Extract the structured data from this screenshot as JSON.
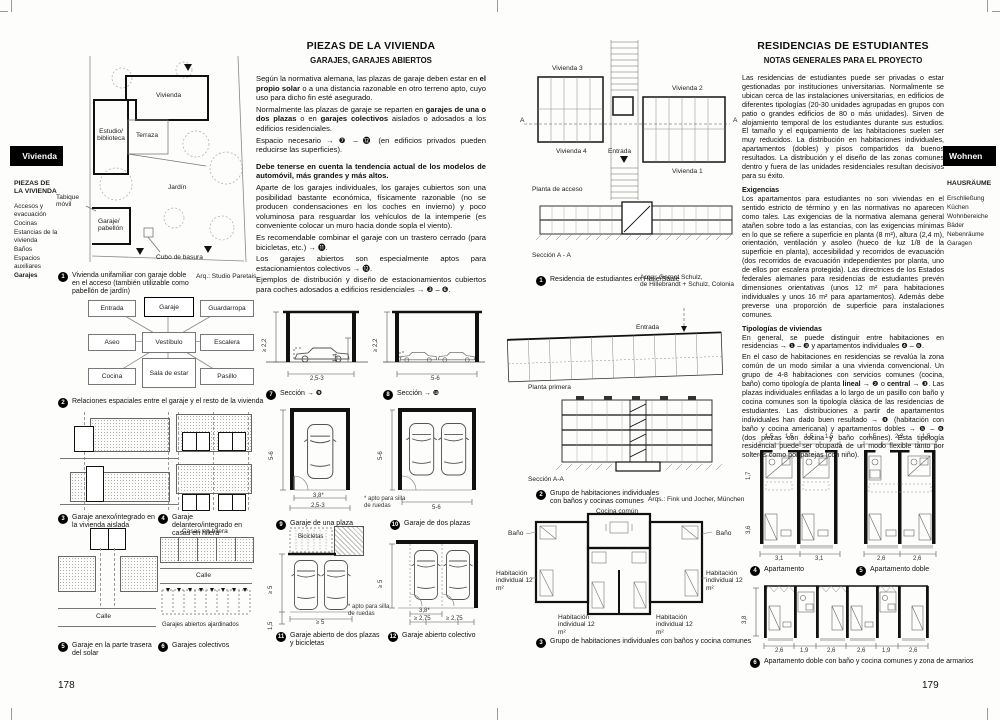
{
  "left_page": {
    "page_number": "178",
    "tab_label": "Vivienda",
    "sidebar": {
      "heading": "PIEZAS DE LA VIVIENDA",
      "items": [
        "Accesos y evacuación",
        "Cocinas",
        "Estancias de la vivienda",
        "Baños",
        "Espacios auxiliares",
        "Garajes"
      ]
    },
    "title": "PIEZAS DE LA VIVIENDA",
    "subtitle": "GARAJES, GARAJES ABIERTOS",
    "body": {
      "p1_a": "Según la normativa alemana, las plazas de garaje deben estar en ",
      "p1_b": "el propio solar",
      "p1_c": " o a una distancia razonable en otro terreno apto, cuyo uso para dicho fin esté asegurado.",
      "p2_a": "Normalmente las plazas de garaje se reparten en ",
      "p2_b": "garajes de una o dos plazas",
      "p2_c": " o en ",
      "p2_d": "garajes colectivos",
      "p2_e": " aislados o adosados a los edificios residenciales.",
      "p3": "Espacio necesario → ❼ – ⓬ (en edificios privados pueden reducirse las superficies).",
      "p4": "Debe tenerse en cuenta la tendencia actual de los modelos de automóvil, más grandes y más altos.",
      "p5": "Aparte de los garajes individuales, los garajes cubiertos son una posibilidad bastante económica, físicamente razonable (no se producen condensaciones en los coches en invierno) y poco voluminosa para resguardar los vehículos de la intemperie (es conveniente colocar un muro hacia donde sopla el viento).",
      "p6": "Es recomendable combinar el garaje con un trastero cerrado (para bicicletas, etc.) → ⓫.",
      "p7": "Los garajes abiertos son especialmente aptos para estacionamientos colectivos → ⓬.",
      "p8": "Ejemplos de distribución y diseño de estacionamientos cubiertos para coches adosados a edificios residenciales → ❸ – ❻."
    },
    "fig1": {
      "num": "1",
      "caption": "Vivienda unifamiliar con garaje doble en el acceso (también utilizable como pabellón de jardín)",
      "credit": "Arq.: Studio Paretais",
      "labels": {
        "vivienda": "Vivienda",
        "estudio": "Estudio/ biblioteca",
        "terraza": "Terraza",
        "jardin": "Jardín",
        "tabique": "Tabique móvil",
        "garaje": "Garaje/ pabellón",
        "cubo": "Cubo de basura"
      }
    },
    "fig2": {
      "num": "2",
      "caption": "Relaciones espaciales entre el garaje y el resto de la vivienda",
      "boxes": [
        "Entrada",
        "Garaje",
        "Guardarropa",
        "Aseo",
        "Vestíbulo",
        "Escalera",
        "Cocina",
        "Sala de estar",
        "Pasillo"
      ]
    },
    "fig3": {
      "num": "3",
      "caption": "Garaje anexo/integrado en la vivienda aislada"
    },
    "fig4": {
      "num": "4",
      "caption": "Garaje delantero/integrado en casas en hilera"
    },
    "fig5": {
      "num": "5",
      "caption": "Garaje en la parte trasera del solar",
      "label_calle": "Calle"
    },
    "fig6": {
      "num": "6",
      "caption": "Garajes colectivos",
      "labels": [
        "Casas en hilera",
        "Calle",
        "Garajes abiertos ajardinados"
      ]
    },
    "fig7": {
      "num": "7",
      "caption": "Sección → ❾",
      "dims": {
        "h": "≥ 2,2",
        "door": "1,4",
        "w": "2,5-3"
      }
    },
    "fig8": {
      "num": "8",
      "caption": "Sección → ❿",
      "dims": {
        "h": "≥ 2,2",
        "w": "5-6"
      }
    },
    "fig9": {
      "num": "9",
      "caption": "Garaje de una plaza",
      "dims": {
        "d": "5-6",
        "w1": "3,8*",
        "w2": "2,5-3"
      },
      "note": "* apto para silla de ruedas"
    },
    "fig10": {
      "num": "10",
      "caption": "Garaje de dos plazas",
      "dims": {
        "d": "5-6",
        "w": "5-6"
      }
    },
    "fig11": {
      "num": "11",
      "caption": "Garaje abierto de dos plazas y bicicletas",
      "label": "Bicicletas",
      "dims": {
        "d": "≥ 5",
        "strip": "1,5",
        "w": "≥ 5"
      }
    },
    "fig12": {
      "num": "12",
      "caption": "Garaje abierto colectivo",
      "note": "* apto para silla de ruedas",
      "dims": {
        "d": "≥ 5",
        "w1": "3,8*",
        "w2": "≥ 2,75",
        "w3": "≥ 2,75"
      }
    }
  },
  "right_page": {
    "page_number": "179",
    "tab_label": "Wohnen",
    "sidebar": {
      "heading": "HAUSRÄUME",
      "items": [
        "Erschließung",
        "Küchen",
        "Wohnbereiche",
        "Bäder",
        "Nebenräume",
        "Garagen"
      ]
    },
    "title": "RESIDENCIAS DE ESTUDIANTES",
    "subtitle": "NOTAS GENERALES PARA EL PROYECTO",
    "body": {
      "intro": "Las residencias de estudiantes puede ser privadas o estar gestionadas por instituciones universitarias. Normalmente se ubican cerca de las instalaciones universitarias, en edificios de diferentes tipologías (20-30 unidades agrupadas en grupos con patio o grandes edificios de 80 o más unidades). Sirven de alojamiento temporal de los estudiantes durante sus estudios. El tamaño y el equipamiento de las habitaciones suelen ser muy reducidos. La distribución en habitaciones individuales, apartamentos (dobles) y pisos compartidos da buenos resultados. La distribución y el diseño de las zonas comunes dentro y fuera de las unidades residenciales resultan decisivos para su éxito.",
      "h_exigencias": "Exigencias",
      "exigencias": "Los apartamentos para estudiantes no son viviendas en el sentido estricto de término y en las normativas no aparecen como tales. Las exigencias de la normativa alemana general atañen sobre todo a las estancias, con las exigencias mínimas en lo que se refiere a superficie en planta (8 m²), altura (2,4 m), orientación, ventilación y asoleo (hueco de luz 1/8 de la superficie en planta), accesibilidad y recorridos de evacuación (dos recorridos de evacuación independientes por planta, uno de ellos por escalera protegida). Las directrices de los Estados federales alemanes para residencias de estudiantes prevén dimensiones orientativas (unos 12 m² para habitaciones individuales y unos 16 m² para apartamentos). Además debe preverse una proporción de superficie para instalaciones comunes.",
      "h_tipologias": "Tipologías de viviendas",
      "tip_a": "En general, se puede distinguir entre habitaciones en residencias → ❶ – ❸ y apartamentos individuales ❹ – ❻.",
      "tip_b": "En el caso de habitaciones en residencias se revalúa la zona común de un modo similar a una vivienda convencional. Un grupo de 4-8 habitaciones con servicios comunes (cocina, baño) como tipología de planta ",
      "tip_bold1": "lineal",
      "tip_c": " → ❷ o ",
      "tip_bold2": "central",
      "tip_d": " → ❸. Las plazas individuales enfiladas a lo largo de un pasillo con baño y cocina comunes son la tipología clásica de las residencias de estudiantes. Las distribuciones a partir de apartamentos individuales han dado buen resultado → ❹ (habitación con baño y cocina americana) y apartamentos dobles → ❺ – ❻ (dos piezas con cocina y baño comunes). Esta tipología residencial puede ser ocupada de un modo flexible tanto por solteros como por parejas (con niño)."
    },
    "fig1": {
      "num": "1",
      "caption": "Residencia de estudiantes en Halle/Saale",
      "credit_1": "Arqs.: Gernot Schulz,",
      "credit_2": "de Hillebrandt + Schulz, Colonia",
      "labels": {
        "v1": "Vivienda 1",
        "v2": "Vivienda 2",
        "v3": "Vivienda 3",
        "v4": "Vivienda 4",
        "entrada": "Entrada",
        "planta": "Planta de acceso",
        "seccion": "Sección A - A",
        "a_left": "A",
        "a_right": "A"
      }
    },
    "fig2": {
      "num": "2",
      "caption_1": "Grupo de habitaciones individuales",
      "caption_2": "con baños y cocinas comunes",
      "credit": "Arqs.: Fink und Jocher, München",
      "labels": {
        "entrada": "Entrada",
        "planta": "Planta primera",
        "seccion": "Sección A-A"
      }
    },
    "fig3": {
      "num": "3",
      "caption": "Grupo de habitaciones individuales con baños y cocina comunes",
      "labels": {
        "cocina": "Cocina común",
        "bano": "Baño",
        "hab": "Habitación individual 12 m²"
      }
    },
    "fig4": {
      "num": "4",
      "caption": "Apartamento",
      "dims_top": [
        "1,5",
        "1,5",
        "1,5",
        "1,5"
      ],
      "dims_left": [
        "1,7",
        "3,6"
      ],
      "dims_bottom": [
        "3,1",
        "3,1"
      ]
    },
    "fig5": {
      "num": "5",
      "caption": "Apartamento doble",
      "dims_top": [
        "1,5",
        "2,2",
        "1,5"
      ],
      "dims_bottom": [
        "2,6",
        "2,6"
      ]
    },
    "fig6": {
      "num": "6",
      "caption": "Apartamento doble con baño y cocina comunes y zona de armarios",
      "dim_left": "3,8",
      "dims_bottom": [
        "2,6",
        "1,9",
        "2,6",
        "2,6",
        "1,9",
        "2,6"
      ]
    }
  }
}
